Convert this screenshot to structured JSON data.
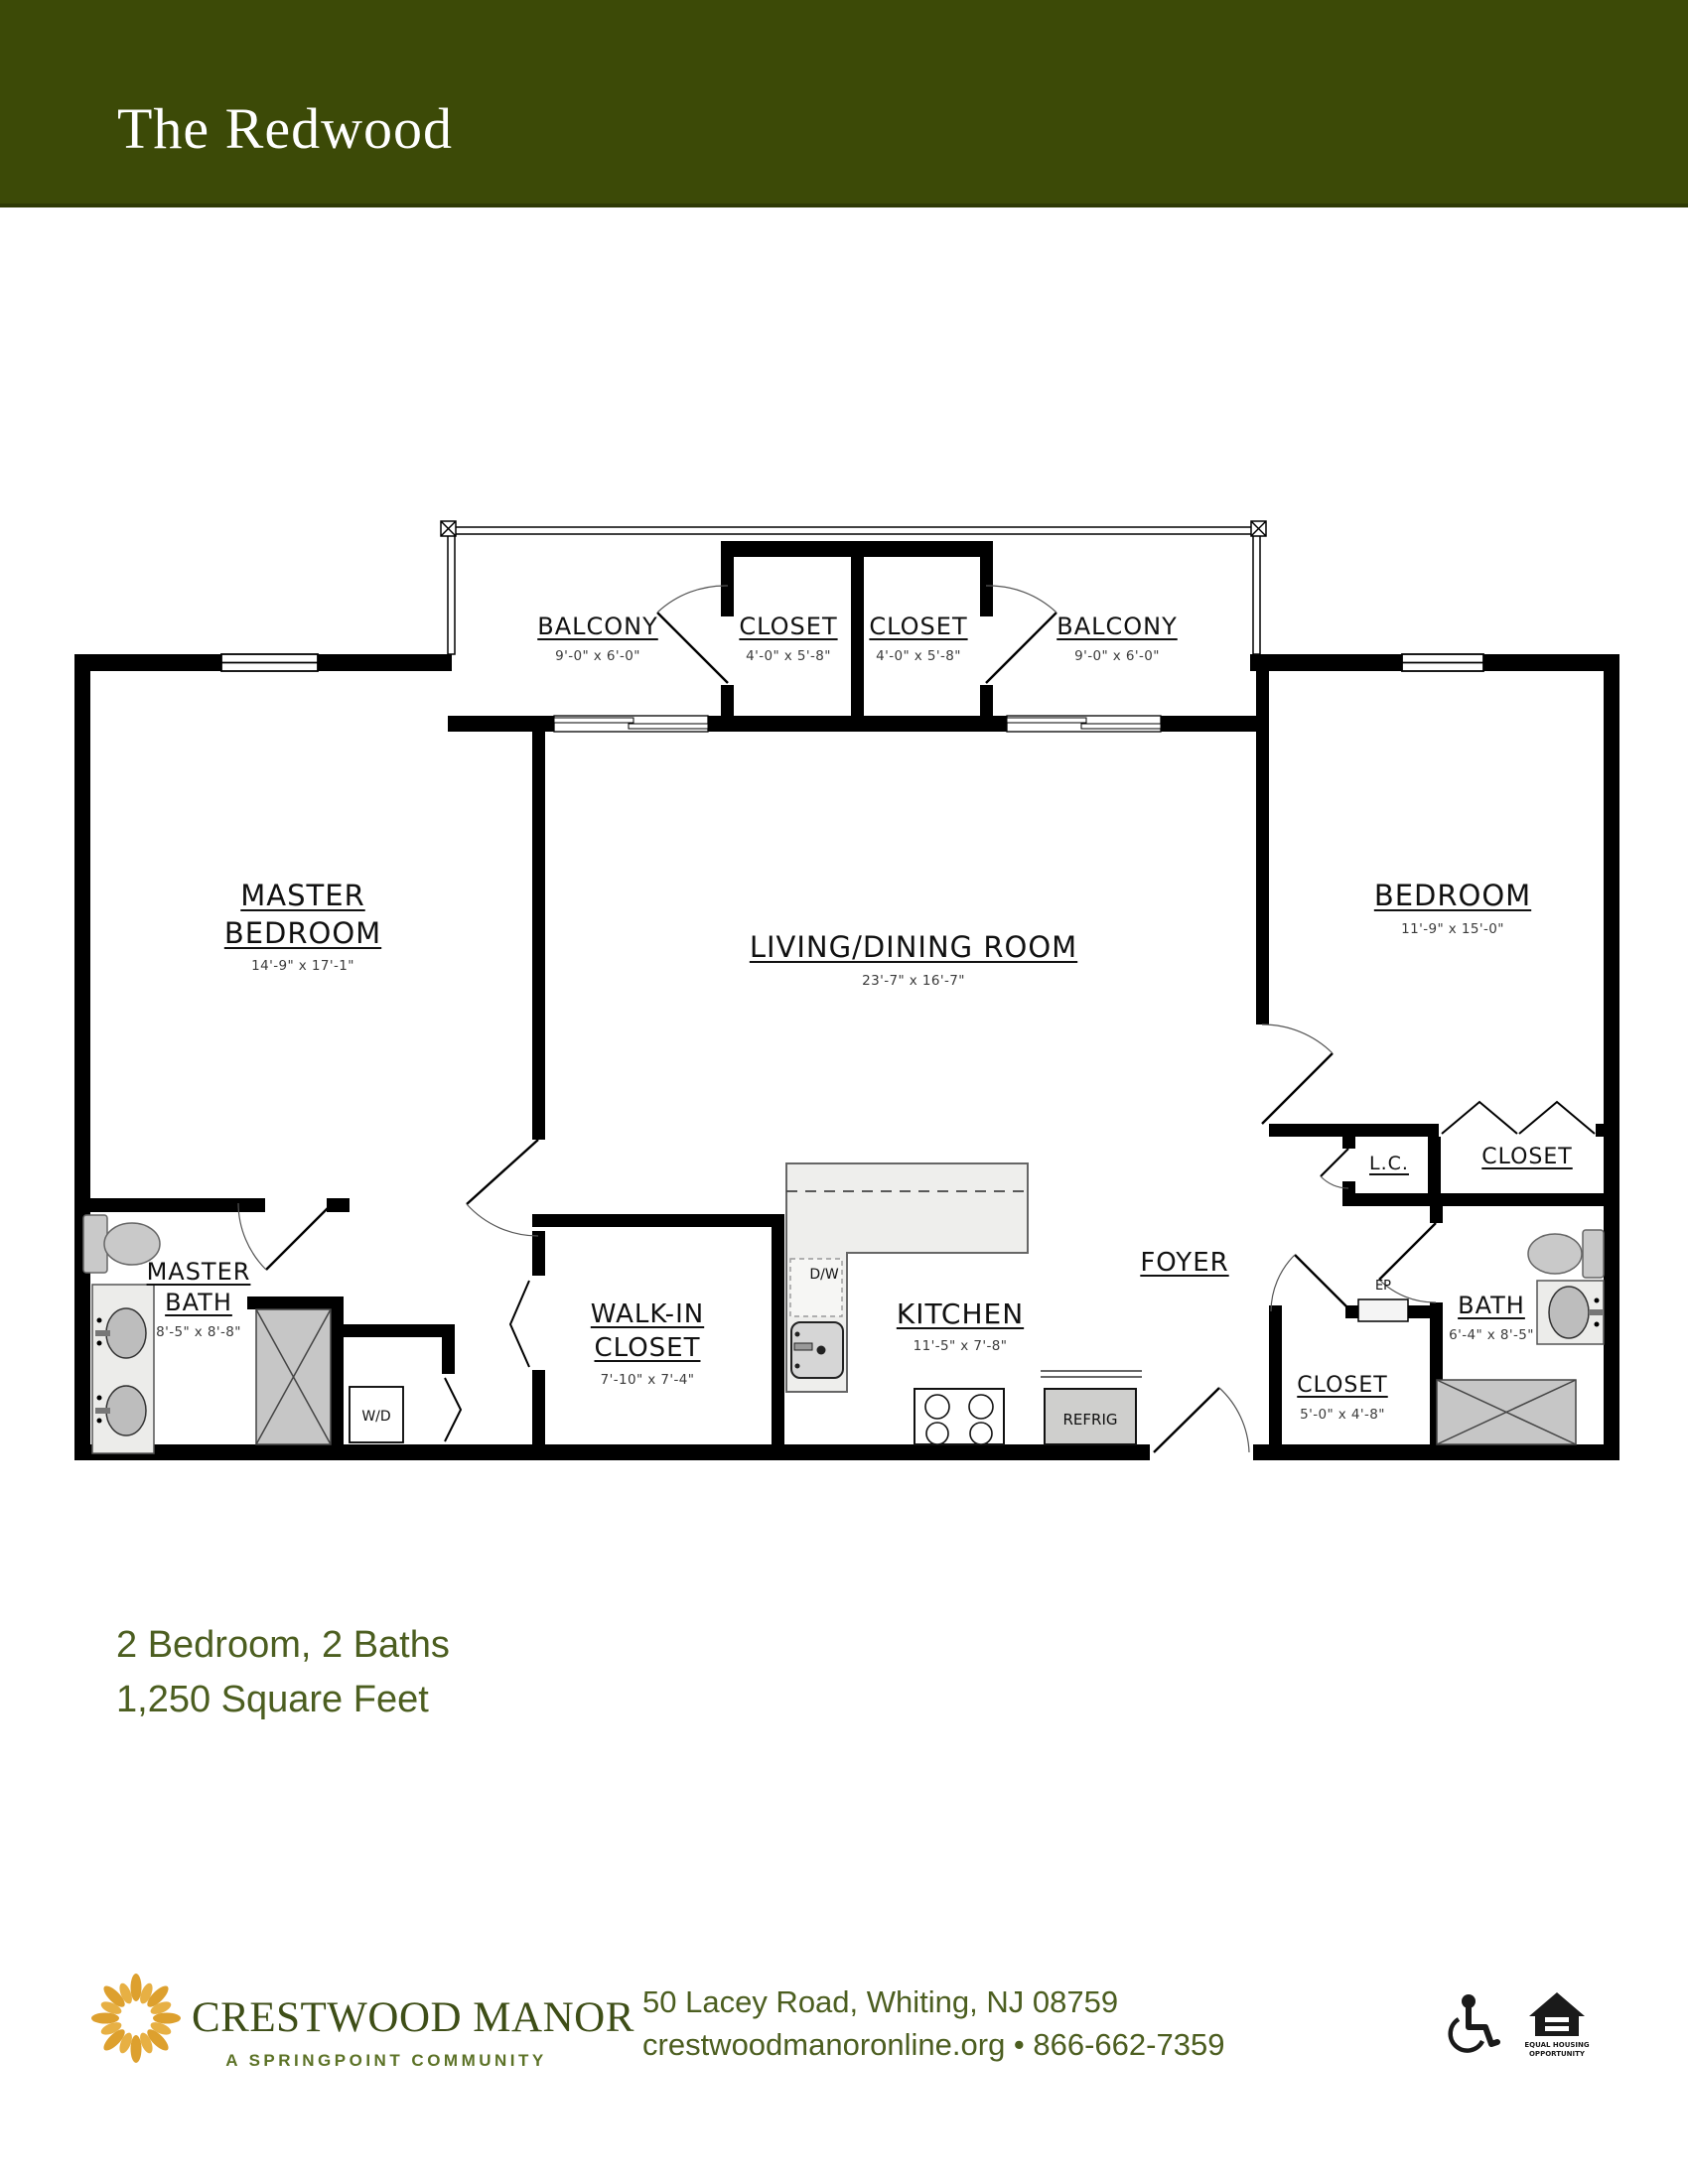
{
  "header": {
    "title": "The Redwood"
  },
  "rooms": {
    "balcony_left": {
      "label": "BALCONY",
      "dims": "9'-0\" x 6'-0\""
    },
    "closet_balcony_left": {
      "label": "CLOSET",
      "dims": "4'-0\" x 5'-8\""
    },
    "closet_balcony_right": {
      "label": "CLOSET",
      "dims": "4'-0\" x 5'-8\""
    },
    "balcony_right": {
      "label": "BALCONY",
      "dims": "9'-0\" x 6'-0\""
    },
    "master_bedroom": {
      "label_line1": "MASTER",
      "label_line2": "BEDROOM",
      "dims": "14'-9\" x 17'-1\""
    },
    "living_dining_room": {
      "label": "LIVING/DINING ROOM",
      "dims": "23'-7\" x 16'-7\""
    },
    "bedroom": {
      "label": "BEDROOM",
      "dims": "11'-9\" x 15'-0\""
    },
    "master_bath": {
      "label_line1": "MASTER",
      "label_line2": "BATH",
      "dims": "8'-5\" x 8'-8\""
    },
    "walk_in_closet": {
      "label_line1": "WALK-IN",
      "label_line2": "CLOSET",
      "dims": "7'-10\" x 7'-4\""
    },
    "kitchen": {
      "label": "KITCHEN",
      "dims": "11'-5\" x 7'-8\""
    },
    "foyer": {
      "label": "FOYER"
    },
    "linen_closet": {
      "label": "L.C."
    },
    "bedroom_closet": {
      "label": "CLOSET"
    },
    "bath": {
      "label": "BATH",
      "dims": "6'-4\" x 8'-5\""
    },
    "foyer_closet": {
      "label": "CLOSET",
      "dims": "5'-0\" x 4'-8\""
    }
  },
  "appliances": {
    "dishwasher": "D/W",
    "washer_dryer": "W/D",
    "refrigerator": "REFRIG",
    "electrical_panel": "EP"
  },
  "summary": {
    "line1": "2 Bedroom, 2 Baths",
    "line2": "1,250 Square Feet"
  },
  "footer": {
    "brand": "CRESTWOOD MANOR",
    "tagline": "A SPRINGPOINT COMMUNITY",
    "address": "50 Lacey Road, Whiting, NJ 08759",
    "contact": "crestwoodmanoronline.org • 866-662-7359",
    "eho_line1": "EQUAL HOUSING",
    "eho_line2": "OPPORTUNITY",
    "icons": [
      "sunburst-logo",
      "wheelchair-accessible-icon",
      "equal-housing-opportunity-icon"
    ]
  },
  "colors": {
    "header_bg": "#3C4A07",
    "text_green": "#4C5E20",
    "brand_green": "#3E4E17",
    "tagline_green": "#5C7226",
    "logo_orange": "#DDA02E"
  }
}
